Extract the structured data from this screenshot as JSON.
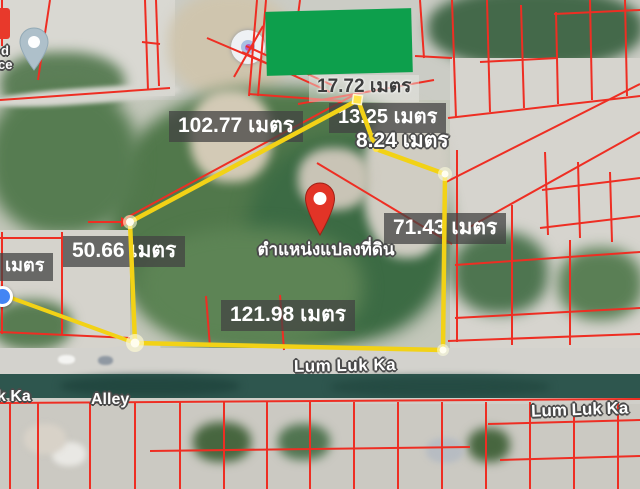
{
  "app": "satellite-map-land-plot-view",
  "plot_labels": {
    "top": "17.72 เมตร",
    "northwest": "102.77 เมตร",
    "northeast_upper": "13.25 เมตร",
    "northeast_lower": "8.24 เมตร",
    "east": "71.43 เมตร",
    "west": "50.66 เมตร",
    "west_edge_partial": "เมตร",
    "south": "121.98 เมตร",
    "pin_caption": "ตำแหน่งแปลงที่ดิน"
  },
  "measurements_meters": [
    17.72,
    102.77,
    13.25,
    8.24,
    71.43,
    50.66,
    121.98
  ],
  "unit_word": "เมตร",
  "road_labels": {
    "main_road": "Lum Luk Ka",
    "bottom_left_partial": "k Ka",
    "alley": "Alley",
    "bottom_right": "Lum Luk Ka"
  },
  "corner_text": {
    "line1": "d",
    "line2": "ce"
  },
  "icons": {
    "plot_pin": "red-map-pin-icon",
    "top_left_pin": "gray-blue-map-pin-icon",
    "poi_circle": "white-circle-marker-icon",
    "blue_dot": "blue-dot-marker-icon",
    "parcel_arrow": "red-arrow-icon"
  },
  "colors": {
    "parcel_lines": "#ee2e23",
    "plot_outline_yellow": "#f2d216",
    "pin_red": "#e23427",
    "censor_block_green": "#0d9f4c",
    "label_box_bg": "rgba(66,66,66,0.74)",
    "label_text": "#ffffff",
    "canal_strip": "#2e564e"
  }
}
